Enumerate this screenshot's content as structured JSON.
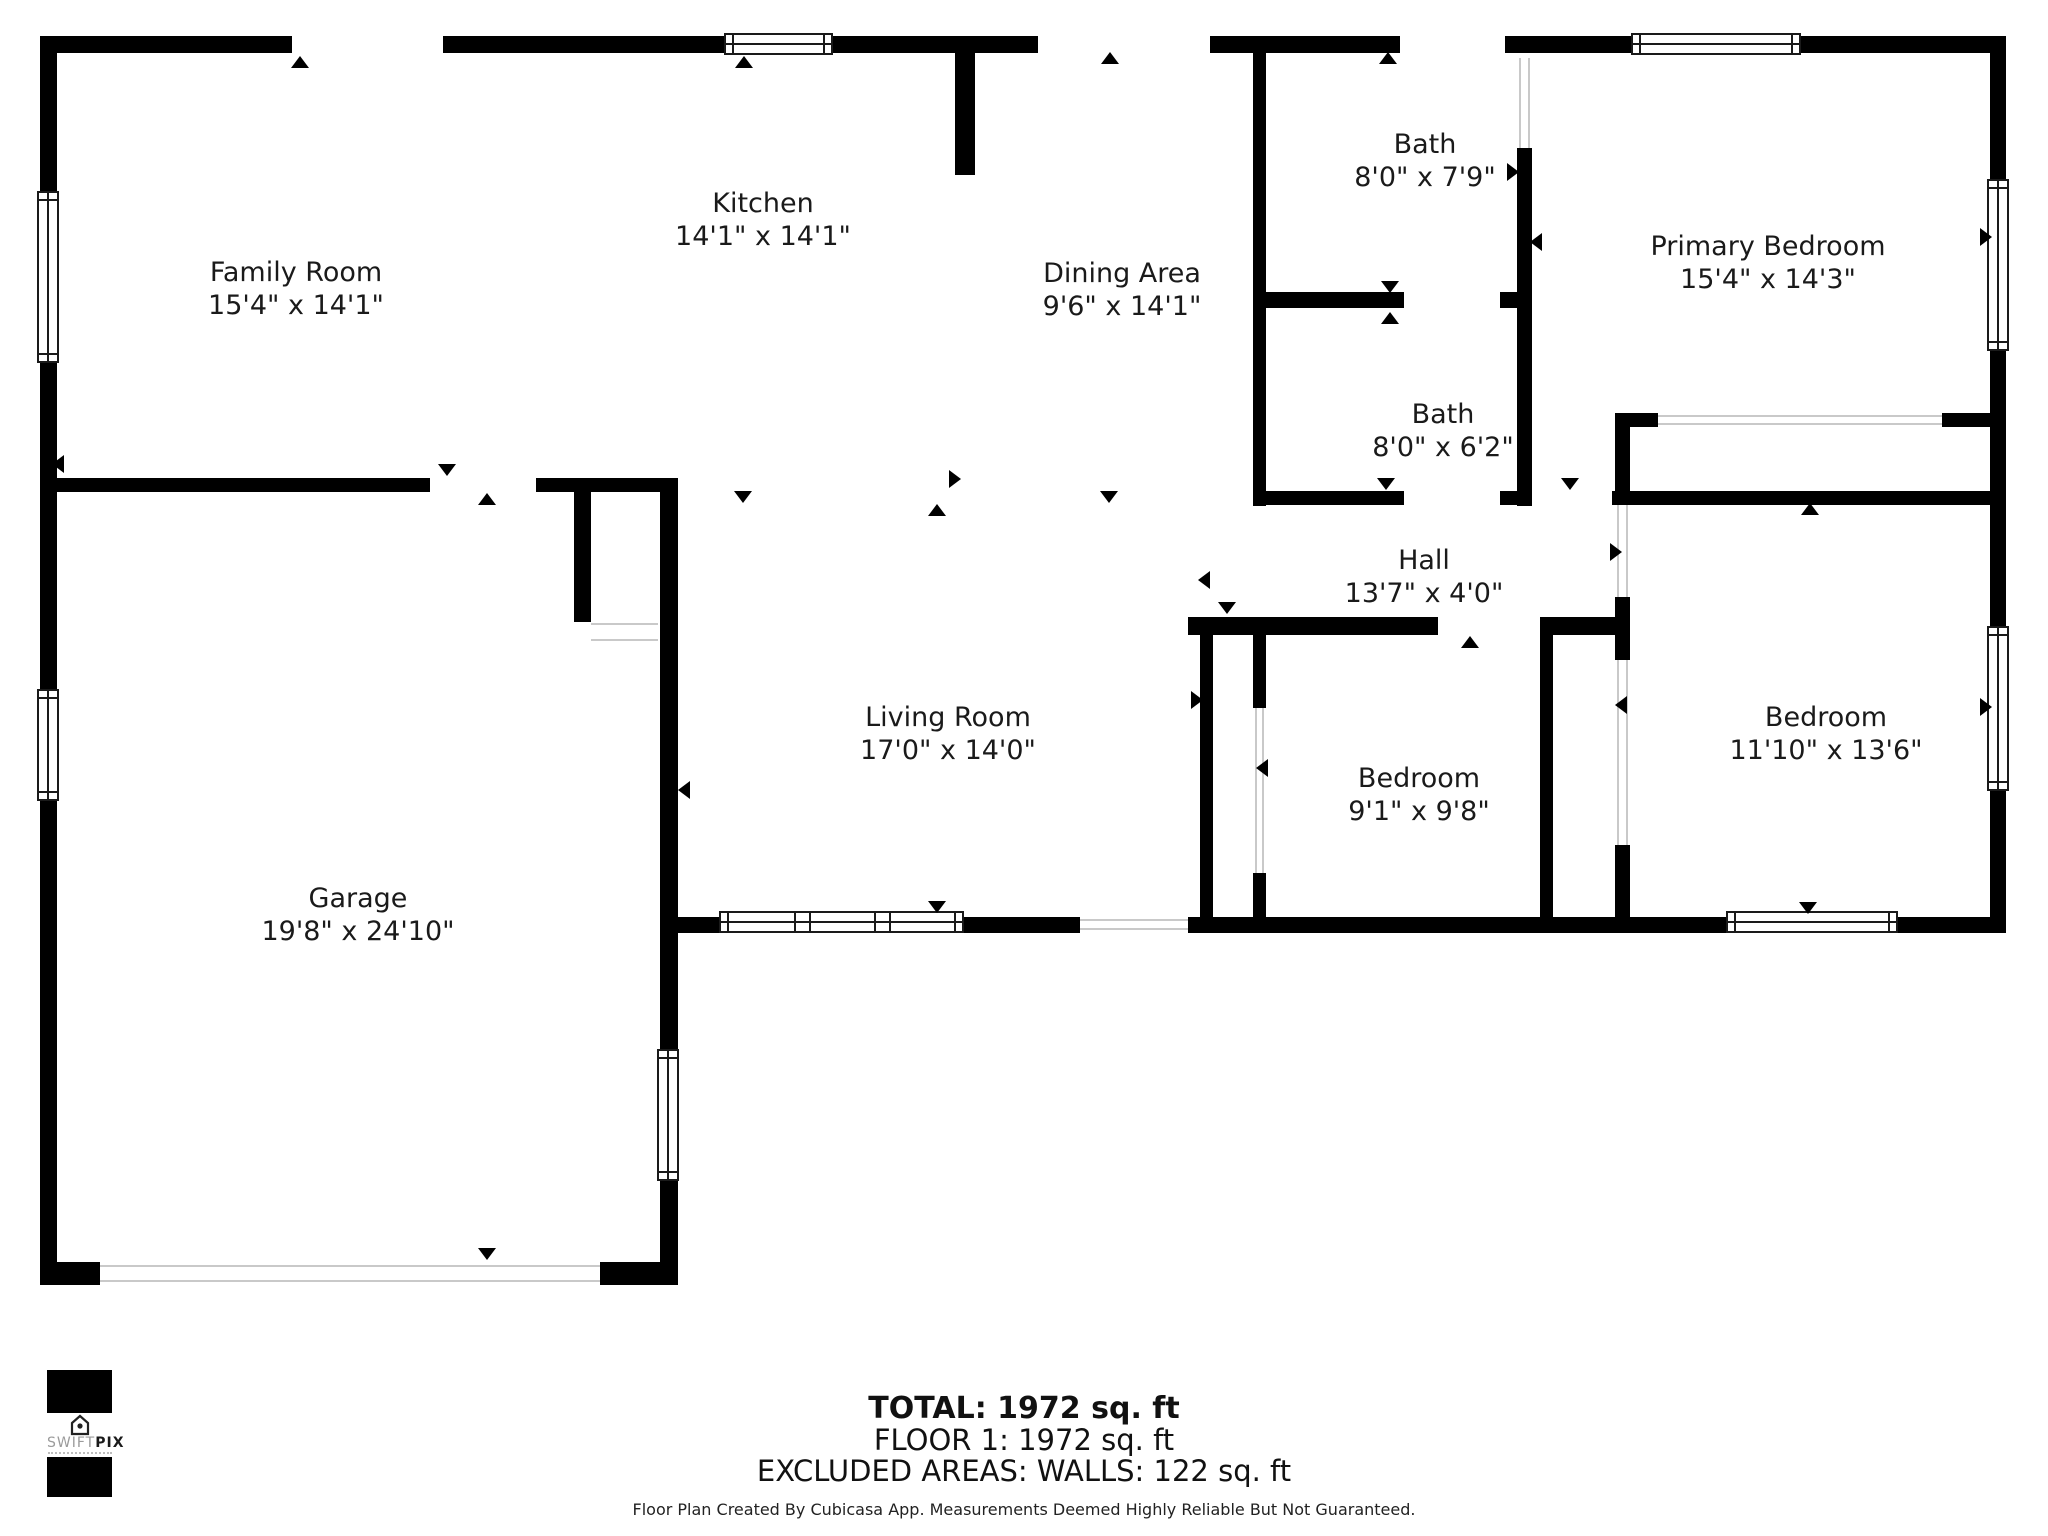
{
  "plan": {
    "rooms": [
      {
        "name": "Family Room",
        "dims": "15'4\" x 14'1\""
      },
      {
        "name": "Kitchen",
        "dims": "14'1\" x 14'1\""
      },
      {
        "name": "Dining Area",
        "dims": "9'6\" x 14'1\""
      },
      {
        "name": "Bath",
        "dims": "8'0\" x 7'9\""
      },
      {
        "name": "Primary Bedroom",
        "dims": "15'4\" x 14'3\""
      },
      {
        "name": "Bath",
        "dims": "8'0\" x 6'2\""
      },
      {
        "name": "Hall",
        "dims": "13'7\" x 4'0\""
      },
      {
        "name": "Living Room",
        "dims": "17'0\" x 14'0\""
      },
      {
        "name": "Bedroom",
        "dims": "9'1\" x 9'8\""
      },
      {
        "name": "Bedroom",
        "dims": "11'10\" x 13'6\""
      },
      {
        "name": "Garage",
        "dims": "19'8\" x 24'10\""
      }
    ],
    "door_markers": [
      {
        "x": 300,
        "y": 62,
        "dir": "up"
      },
      {
        "x": 744,
        "y": 62,
        "dir": "up"
      },
      {
        "x": 1110,
        "y": 58,
        "dir": "up"
      },
      {
        "x": 1388,
        "y": 58,
        "dir": "up"
      },
      {
        "x": 447,
        "y": 470,
        "dir": "down"
      },
      {
        "x": 487,
        "y": 499,
        "dir": "up"
      },
      {
        "x": 58,
        "y": 464,
        "dir": "left"
      },
      {
        "x": 743,
        "y": 497,
        "dir": "down"
      },
      {
        "x": 937,
        "y": 510,
        "dir": "up"
      },
      {
        "x": 1109,
        "y": 497,
        "dir": "down"
      },
      {
        "x": 955,
        "y": 479,
        "dir": "right"
      },
      {
        "x": 1204,
        "y": 580,
        "dir": "left"
      },
      {
        "x": 1386,
        "y": 484,
        "dir": "down"
      },
      {
        "x": 1390,
        "y": 287,
        "dir": "down"
      },
      {
        "x": 1390,
        "y": 318,
        "dir": "up"
      },
      {
        "x": 1570,
        "y": 484,
        "dir": "down"
      },
      {
        "x": 1810,
        "y": 509,
        "dir": "up"
      },
      {
        "x": 1616,
        "y": 552,
        "dir": "right"
      },
      {
        "x": 1621,
        "y": 705,
        "dir": "left"
      },
      {
        "x": 1470,
        "y": 642,
        "dir": "up"
      },
      {
        "x": 1227,
        "y": 608,
        "dir": "down"
      },
      {
        "x": 1197,
        "y": 700,
        "dir": "right"
      },
      {
        "x": 1262,
        "y": 768,
        "dir": "left"
      },
      {
        "x": 487,
        "y": 1254,
        "dir": "down"
      },
      {
        "x": 684,
        "y": 790,
        "dir": "left"
      },
      {
        "x": 937,
        "y": 907,
        "dir": "down"
      },
      {
        "x": 1808,
        "y": 908,
        "dir": "down"
      },
      {
        "x": 1986,
        "y": 237,
        "dir": "right"
      },
      {
        "x": 1986,
        "y": 707,
        "dir": "right"
      },
      {
        "x": 1513,
        "y": 172,
        "dir": "right"
      },
      {
        "x": 1536,
        "y": 242,
        "dir": "left"
      }
    ]
  },
  "footer": {
    "total": "TOTAL: 1972 sq. ft",
    "floor": "FLOOR 1: 1972 sq. ft",
    "excluded": "EXCLUDED AREAS: WALLS: 122 sq. ft",
    "disclaimer": "Floor Plan Created By Cubicasa App. Measurements Deemed Highly Reliable But Not Guaranteed."
  },
  "logo": {
    "brand_primary": "SWIFT",
    "brand_secondary": "PIX",
    "house_icon": "house-camera-icon"
  },
  "colors": {
    "wall": "#000000",
    "text": "#1a1a1a",
    "opening_line": "#c9c9c9",
    "window_stroke": "#1a1a1a",
    "logo_gray": "#9b9b9b"
  }
}
